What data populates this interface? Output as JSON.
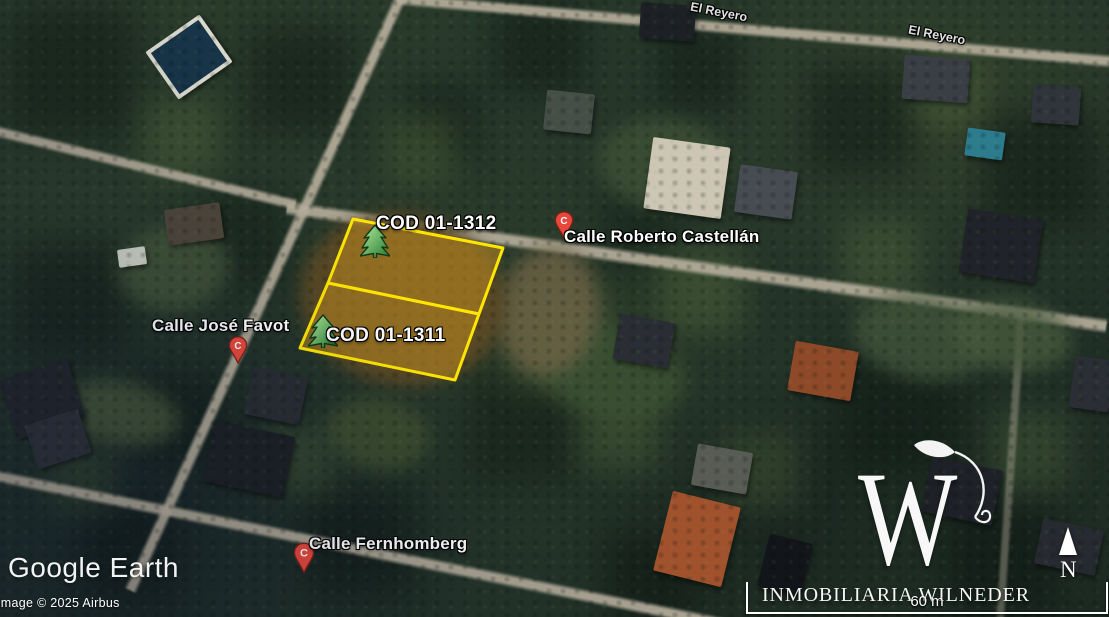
{
  "app": {
    "brand": "Google Earth",
    "attribution": "Image © 2025 Airbus"
  },
  "map": {
    "street_labels": [
      {
        "name": "El Reyero",
        "type": "road-label"
      },
      {
        "name": "El Reyero",
        "type": "road-label"
      },
      {
        "name": "Calle Roberto Castellán",
        "type": "placemark",
        "pin_letter": "C"
      },
      {
        "name": "Calle José Favot",
        "type": "placemark",
        "pin_letter": "C"
      },
      {
        "name": "Calle Fernhomberg",
        "type": "placemark",
        "pin_letter": "C"
      }
    ],
    "parcels": [
      {
        "code": "COD 01-1312"
      },
      {
        "code": "COD 01-1311"
      }
    ],
    "parcel_style": {
      "stroke": "#ffe600",
      "fill": "rgba(197,143,32,0.52)"
    },
    "pin_style": {
      "fill": "#e8483b"
    },
    "tree_icon_color": "#3fa84c",
    "scale_bar": {
      "label": "60 m"
    },
    "compass": {
      "label": "N"
    }
  },
  "watermark": {
    "initial": "W",
    "company": "INMOBILIARIA WILNEDER"
  },
  "icons": {
    "placemark-pin": "red paddle map pin",
    "tree-icon": "green pine tree placemark",
    "north-arrow-icon": "▲"
  }
}
